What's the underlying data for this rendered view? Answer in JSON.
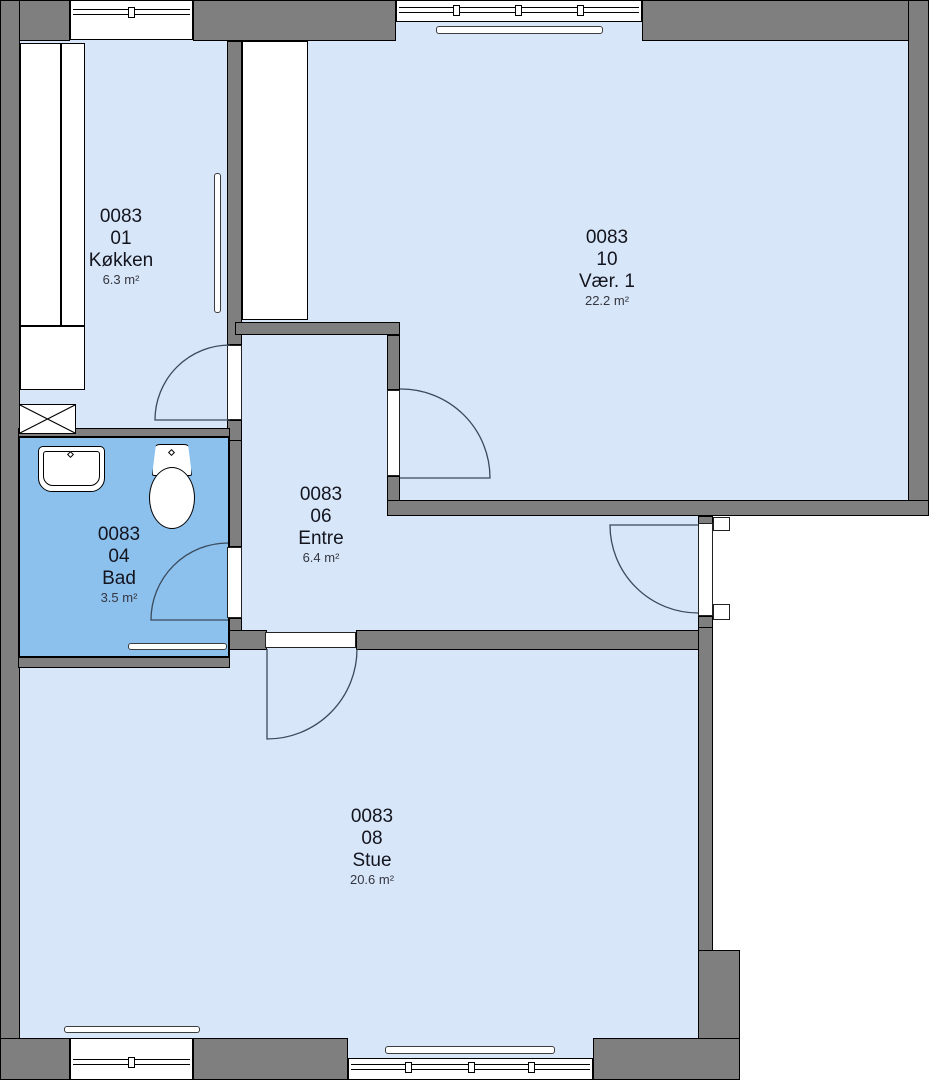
{
  "rooms": [
    {
      "code": "0083",
      "unit": "01",
      "name": "Køkken",
      "area": "6.3 m²"
    },
    {
      "code": "0083",
      "unit": "10",
      "name": "Vær. 1",
      "area": "22.2 m²"
    },
    {
      "code": "0083",
      "unit": "04",
      "name": "Bad",
      "area": "3.5 m²"
    },
    {
      "code": "0083",
      "unit": "06",
      "name": "Entre",
      "area": "6.4 m²"
    },
    {
      "code": "0083",
      "unit": "08",
      "name": "Stue",
      "area": "20.6 m²"
    }
  ],
  "fixtures": [
    "kitchen-counter",
    "wardrobe",
    "vent-shaft",
    "sink",
    "toilet",
    "radiator-kitchen",
    "radiator-vaer1",
    "radiator-bad",
    "radiator-stue-left",
    "radiator-stue-center",
    "door-kitchen",
    "door-vaer1",
    "door-bad",
    "door-stue",
    "door-entrance",
    "window-kitchen",
    "window-vaer1",
    "window-stue-left",
    "window-stue-center"
  ],
  "colors": {
    "wall": "#7f7f7f",
    "room_floor": "#d7e7f9",
    "bath_floor": "#8cc1ee",
    "outline": "#000000",
    "door_arc": "#3a4a5a"
  }
}
